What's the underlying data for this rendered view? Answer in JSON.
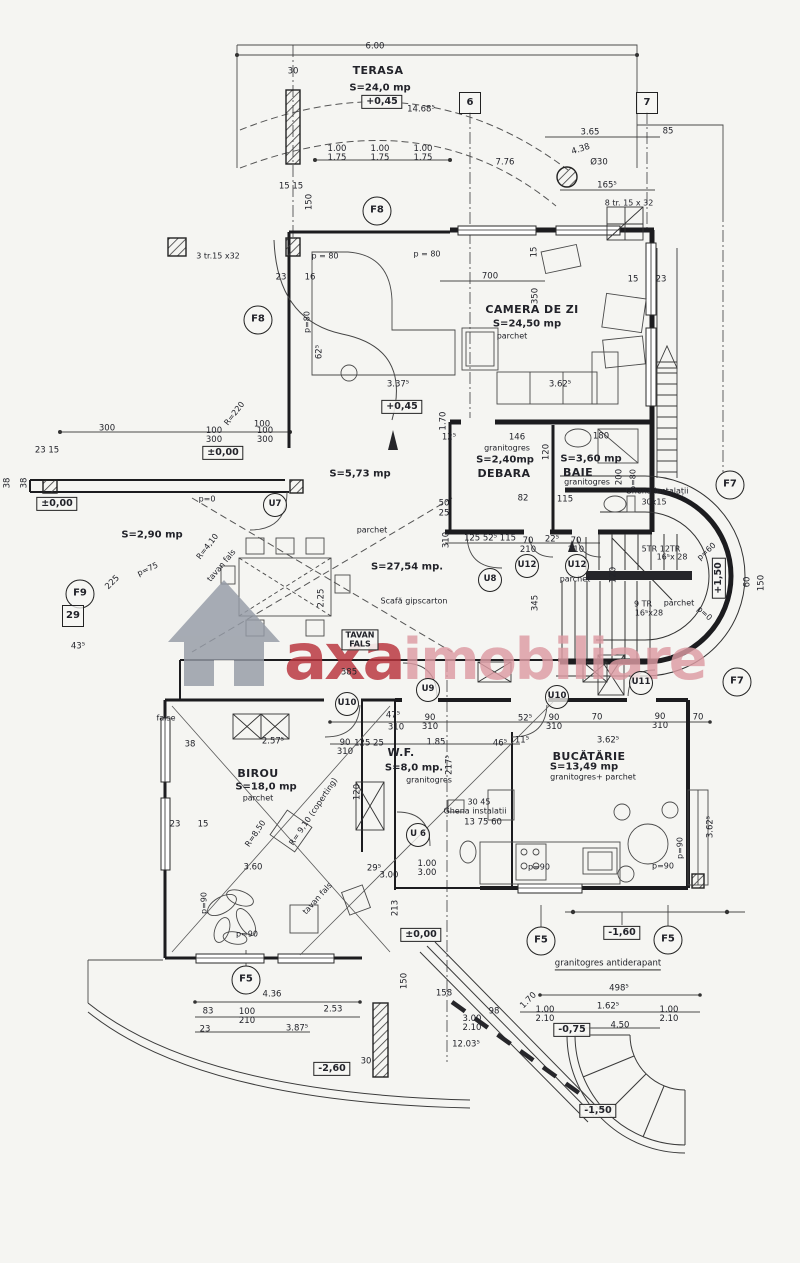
{
  "watermark": {
    "brand": {
      "primary": "axa",
      "secondary": "imobiliare"
    },
    "colors": {
      "primary": "#b9323c",
      "secondary": "#dd9ba3",
      "house": "#959ba6"
    }
  },
  "plan": {
    "labels": [
      {
        "t": "TERASA",
        "x": 378,
        "y": 71,
        "k": "rname"
      },
      {
        "t": "CAMERA DE ZI",
        "x": 532,
        "y": 310,
        "k": "rname"
      },
      {
        "t": "DEBARA",
        "x": 504,
        "y": 474,
        "k": "rname"
      },
      {
        "t": "BAIE",
        "x": 578,
        "y": 473,
        "k": "rname"
      },
      {
        "t": "BIROU",
        "x": 258,
        "y": 774,
        "k": "rname"
      },
      {
        "t": "W.F.",
        "x": 401,
        "y": 753,
        "k": "rname"
      },
      {
        "t": "BUCĂTĂRIE",
        "x": 589,
        "y": 757,
        "k": "rname"
      },
      {
        "t": "S=24,0 mp",
        "x": 380,
        "y": 89,
        "k": "rarea"
      },
      {
        "t": "S=24,50 mp",
        "x": 527,
        "y": 325,
        "k": "rarea"
      },
      {
        "t": "S=2,40mp",
        "x": 505,
        "y": 461,
        "k": "rarea"
      },
      {
        "t": "S=3,60 mp",
        "x": 591,
        "y": 460,
        "k": "rarea"
      },
      {
        "t": "S=5,73 mp",
        "x": 360,
        "y": 475,
        "k": "rarea"
      },
      {
        "t": "S=2,90 mp",
        "x": 152,
        "y": 536,
        "k": "rarea"
      },
      {
        "t": "S=27,54 mp.",
        "x": 407,
        "y": 568,
        "k": "rarea"
      },
      {
        "t": "S=18,0 mp",
        "x": 266,
        "y": 788,
        "k": "rarea"
      },
      {
        "t": "S=8,0 mp.",
        "x": 414,
        "y": 769,
        "k": "rarea"
      },
      {
        "t": "S=13,49 mp",
        "x": 584,
        "y": 768,
        "k": "rarea"
      },
      {
        "t": "parchet",
        "x": 512,
        "y": 337,
        "k": "fin"
      },
      {
        "t": "granitogres",
        "x": 507,
        "y": 449,
        "k": "fin"
      },
      {
        "t": "granitogres",
        "x": 587,
        "y": 483,
        "k": "fin"
      },
      {
        "t": "parchet",
        "x": 372,
        "y": 531,
        "k": "fin"
      },
      {
        "t": "parchet",
        "x": 575,
        "y": 580,
        "k": "fin"
      },
      {
        "t": "parchet",
        "x": 679,
        "y": 604,
        "k": "fin"
      },
      {
        "t": "granitogres",
        "x": 429,
        "y": 781,
        "k": "fin"
      },
      {
        "t": "granitogres+ parchet",
        "x": 593,
        "y": 778,
        "k": "fin"
      },
      {
        "t": "parchet",
        "x": 258,
        "y": 799,
        "k": "fin"
      },
      {
        "t": "Scafă gipscarton",
        "x": 414,
        "y": 602,
        "k": "note"
      },
      {
        "t": "Ghenă instalații",
        "x": 657,
        "y": 492,
        "k": "note"
      },
      {
        "t": "30x15",
        "x": 654,
        "y": 503,
        "k": "note"
      },
      {
        "t": "Ghena instalatii",
        "x": 475,
        "y": 812,
        "k": "note"
      },
      {
        "t": "30 45",
        "x": 479,
        "y": 803,
        "k": "note"
      },
      {
        "t": "false",
        "x": 166,
        "y": 719,
        "k": "note"
      },
      {
        "t": "3 tr.15 x32",
        "x": 218,
        "y": 257,
        "k": "note"
      },
      {
        "t": "8 tr. 15 x 32",
        "x": 629,
        "y": 204,
        "k": "note"
      },
      {
        "t": "5TR  12TR",
        "x": 661,
        "y": 550,
        "k": "note"
      },
      {
        "t": "16⁵x 28",
        "x": 672,
        "y": 558,
        "k": "note"
      },
      {
        "t": "9 TR",
        "x": 643,
        "y": 605,
        "k": "note"
      },
      {
        "t": "16⁵x28",
        "x": 649,
        "y": 614,
        "k": "note"
      },
      {
        "t": "granitogres antiderapant",
        "x": 608,
        "y": 965,
        "k": "noteul"
      },
      {
        "t": "tavan fals",
        "x": 222,
        "y": 566,
        "k": "note",
        "r": -50
      },
      {
        "t": "tavan fals",
        "x": 318,
        "y": 899,
        "k": "note",
        "r": -48
      },
      {
        "t": "p = 80",
        "x": 325,
        "y": 257,
        "k": "slope"
      },
      {
        "t": "p = 80",
        "x": 427,
        "y": 255,
        "k": "slope"
      },
      {
        "t": "p=80",
        "x": 308,
        "y": 322,
        "k": "slope",
        "r": -90
      },
      {
        "t": "p=80",
        "x": 634,
        "y": 480,
        "k": "slope",
        "r": -90
      },
      {
        "t": "p=0",
        "x": 207,
        "y": 500,
        "k": "slope"
      },
      {
        "t": "p=75",
        "x": 148,
        "y": 570,
        "k": "slope",
        "r": -25
      },
      {
        "t": "p=60",
        "x": 707,
        "y": 552,
        "k": "slope",
        "r": -42
      },
      {
        "t": "p=0",
        "x": 704,
        "y": 614,
        "k": "slope",
        "r": 42
      },
      {
        "t": "p=90",
        "x": 247,
        "y": 935,
        "k": "slope"
      },
      {
        "t": "p=90",
        "x": 205,
        "y": 903,
        "k": "slope",
        "r": -90
      },
      {
        "t": "p=90",
        "x": 539,
        "y": 868,
        "k": "slope"
      },
      {
        "t": "p=90",
        "x": 663,
        "y": 867,
        "k": "slope"
      },
      {
        "t": "p=90",
        "x": 681,
        "y": 848,
        "k": "slope",
        "r": -90
      },
      {
        "t": "R=220",
        "x": 235,
        "y": 414,
        "k": "radius",
        "r": -52
      },
      {
        "t": "R=4,10",
        "x": 208,
        "y": 547,
        "k": "radius",
        "r": -52
      },
      {
        "t": "R=8,50",
        "x": 256,
        "y": 834,
        "k": "radius",
        "r": -56
      },
      {
        "t": "R= 9,10 (coperting)",
        "x": 314,
        "y": 812,
        "k": "radius",
        "r": -56
      },
      {
        "t": "+0,45",
        "x": 382,
        "y": 102,
        "k": "level"
      },
      {
        "t": "+0,45",
        "x": 402,
        "y": 407,
        "k": "level"
      },
      {
        "t": "±0,00",
        "x": 223,
        "y": 453,
        "k": "level"
      },
      {
        "t": "±0,00",
        "x": 57,
        "y": 504,
        "k": "level"
      },
      {
        "t": "±0,00",
        "x": 421,
        "y": 935,
        "k": "level"
      },
      {
        "t": "-1,60",
        "x": 622,
        "y": 933,
        "k": "level"
      },
      {
        "t": "-2,60",
        "x": 332,
        "y": 1069,
        "k": "level"
      },
      {
        "t": "-0,75",
        "x": 572,
        "y": 1030,
        "k": "level"
      },
      {
        "t": "-1,50",
        "x": 598,
        "y": 1111,
        "k": "level"
      },
      {
        "t": "+1,50",
        "x": 719,
        "y": 578,
        "k": "level",
        "r": -90
      },
      {
        "t": "TAVAN\nFALS",
        "x": 360,
        "y": 640,
        "k": "box2"
      },
      {
        "t": "F8",
        "x": 377,
        "y": 211,
        "k": "axisF"
      },
      {
        "t": "F8",
        "x": 258,
        "y": 320,
        "k": "axisF"
      },
      {
        "t": "F9",
        "x": 80,
        "y": 594,
        "k": "axisF"
      },
      {
        "t": "F7",
        "x": 730,
        "y": 485,
        "k": "axisF"
      },
      {
        "t": "F7",
        "x": 737,
        "y": 682,
        "k": "axisF"
      },
      {
        "t": "F5",
        "x": 246,
        "y": 980,
        "k": "axisF"
      },
      {
        "t": "F5",
        "x": 541,
        "y": 941,
        "k": "axisF"
      },
      {
        "t": "F5",
        "x": 668,
        "y": 940,
        "k": "axisF"
      },
      {
        "t": "U7",
        "x": 275,
        "y": 505,
        "k": "axisU"
      },
      {
        "t": "U8",
        "x": 490,
        "y": 580,
        "k": "axisU"
      },
      {
        "t": "U9",
        "x": 428,
        "y": 690,
        "k": "axisU"
      },
      {
        "t": "U10",
        "x": 347,
        "y": 704,
        "k": "axisU"
      },
      {
        "t": "U10",
        "x": 557,
        "y": 697,
        "k": "axisU"
      },
      {
        "t": "U11",
        "x": 641,
        "y": 683,
        "k": "axisU"
      },
      {
        "t": "U12",
        "x": 527,
        "y": 566,
        "k": "axisU"
      },
      {
        "t": "U12",
        "x": 577,
        "y": 566,
        "k": "axisU"
      },
      {
        "t": "U 6",
        "x": 418,
        "y": 835,
        "k": "axisU"
      },
      {
        "t": "6",
        "x": 470,
        "y": 103,
        "k": "grid"
      },
      {
        "t": "7",
        "x": 647,
        "y": 103,
        "k": "grid"
      },
      {
        "t": "29",
        "x": 73,
        "y": 616,
        "k": "grid"
      },
      {
        "t": "6.00",
        "x": 375,
        "y": 47,
        "k": "dim"
      },
      {
        "t": "30",
        "x": 293,
        "y": 72,
        "k": "dim"
      },
      {
        "t": "14.68⁵",
        "x": 421,
        "y": 110,
        "k": "dim"
      },
      {
        "t": "3.65",
        "x": 590,
        "y": 133,
        "k": "dim"
      },
      {
        "t": "85",
        "x": 668,
        "y": 132,
        "k": "dim"
      },
      {
        "t": "1.00\n1.75",
        "x": 337,
        "y": 154,
        "k": "dim2"
      },
      {
        "t": "1.00\n1.75",
        "x": 380,
        "y": 154,
        "k": "dim2"
      },
      {
        "t": "1.00\n1.75",
        "x": 423,
        "y": 154,
        "k": "dim2"
      },
      {
        "t": "7.76",
        "x": 505,
        "y": 163,
        "k": "dim"
      },
      {
        "t": "4.38",
        "x": 581,
        "y": 150,
        "k": "dim",
        "r": -18
      },
      {
        "t": "Ø30",
        "x": 599,
        "y": 163,
        "k": "dim"
      },
      {
        "t": "165⁵",
        "x": 607,
        "y": 186,
        "k": "dim"
      },
      {
        "t": "15 15",
        "x": 291,
        "y": 187,
        "k": "dim"
      },
      {
        "t": "150",
        "x": 310,
        "y": 202,
        "k": "dim",
        "r": -90
      },
      {
        "t": "23",
        "x": 281,
        "y": 278,
        "k": "dim"
      },
      {
        "t": "16",
        "x": 310,
        "y": 278,
        "k": "dim"
      },
      {
        "t": "700",
        "x": 490,
        "y": 277,
        "k": "dim"
      },
      {
        "t": "15",
        "x": 535,
        "y": 252,
        "k": "dim",
        "r": -90
      },
      {
        "t": "350",
        "x": 536,
        "y": 296,
        "k": "dim",
        "r": -90
      },
      {
        "t": "15",
        "x": 633,
        "y": 280,
        "k": "dim"
      },
      {
        "t": "23",
        "x": 661,
        "y": 280,
        "k": "dim"
      },
      {
        "t": "62⁵",
        "x": 320,
        "y": 352,
        "k": "dim",
        "r": -90
      },
      {
        "t": "3.37⁵",
        "x": 398,
        "y": 385,
        "k": "dim"
      },
      {
        "t": "3.62⁵",
        "x": 560,
        "y": 385,
        "k": "dim"
      },
      {
        "t": "100",
        "x": 262,
        "y": 425,
        "k": "dim"
      },
      {
        "t": "300",
        "x": 107,
        "y": 429,
        "k": "dim"
      },
      {
        "t": "100\n300",
        "x": 214,
        "y": 436,
        "k": "dim2"
      },
      {
        "t": "100\n300",
        "x": 265,
        "y": 436,
        "k": "dim2"
      },
      {
        "t": "23 15",
        "x": 47,
        "y": 451,
        "k": "dim"
      },
      {
        "t": "38",
        "x": 8,
        "y": 483,
        "k": "dim",
        "r": -90
      },
      {
        "t": "38",
        "x": 25,
        "y": 483,
        "k": "dim",
        "r": -90
      },
      {
        "t": "1.70",
        "x": 444,
        "y": 421,
        "k": "dim",
        "r": -90
      },
      {
        "t": "12⁵",
        "x": 449,
        "y": 438,
        "k": "dim"
      },
      {
        "t": "146",
        "x": 517,
        "y": 438,
        "k": "dim"
      },
      {
        "t": "120",
        "x": 547,
        "y": 452,
        "k": "dim",
        "r": -90
      },
      {
        "t": "180",
        "x": 601,
        "y": 437,
        "k": "dim"
      },
      {
        "t": "200",
        "x": 620,
        "y": 477,
        "k": "dim",
        "r": -90
      },
      {
        "t": "82",
        "x": 523,
        "y": 499,
        "k": "dim"
      },
      {
        "t": "115",
        "x": 565,
        "y": 500,
        "k": "dim"
      },
      {
        "t": "50",
        "x": 444,
        "y": 504,
        "k": "dim"
      },
      {
        "t": "25",
        "x": 444,
        "y": 514,
        "k": "dim"
      },
      {
        "t": "310",
        "x": 447,
        "y": 540,
        "k": "dim",
        "r": -90
      },
      {
        "t": "125 52⁵ 115",
        "x": 490,
        "y": 539,
        "k": "dim"
      },
      {
        "t": "70\n210",
        "x": 528,
        "y": 546,
        "k": "dim2"
      },
      {
        "t": "22⁵",
        "x": 552,
        "y": 540,
        "k": "dim"
      },
      {
        "t": "70\n210",
        "x": 576,
        "y": 546,
        "k": "dim2"
      },
      {
        "t": "345",
        "x": 536,
        "y": 603,
        "k": "dim",
        "r": -90
      },
      {
        "t": "225",
        "x": 113,
        "y": 583,
        "k": "dim",
        "r": -45
      },
      {
        "t": "2.25",
        "x": 322,
        "y": 598,
        "k": "dim",
        "r": -90
      },
      {
        "t": "43⁵",
        "x": 78,
        "y": 647,
        "k": "dim"
      },
      {
        "t": "385",
        "x": 349,
        "y": 673,
        "k": "dim"
      },
      {
        "t": "120",
        "x": 614,
        "y": 575,
        "k": "dim",
        "r": -90
      },
      {
        "t": "60",
        "x": 748,
        "y": 582,
        "k": "dim",
        "r": -90
      },
      {
        "t": "150",
        "x": 762,
        "y": 583,
        "k": "dim",
        "r": -90
      },
      {
        "t": "38",
        "x": 190,
        "y": 745,
        "k": "dim"
      },
      {
        "t": "2.57⁵",
        "x": 273,
        "y": 742,
        "k": "dim"
      },
      {
        "t": "90\n310",
        "x": 345,
        "y": 748,
        "k": "dim2"
      },
      {
        "t": "125 25",
        "x": 369,
        "y": 744,
        "k": "dim"
      },
      {
        "t": "47⁵",
        "x": 393,
        "y": 716,
        "k": "dim"
      },
      {
        "t": "310",
        "x": 396,
        "y": 728,
        "k": "dim"
      },
      {
        "t": "90\n310",
        "x": 430,
        "y": 723,
        "k": "dim2"
      },
      {
        "t": "1.85",
        "x": 436,
        "y": 743,
        "k": "dim"
      },
      {
        "t": "52⁵",
        "x": 525,
        "y": 719,
        "k": "dim"
      },
      {
        "t": "90\n310",
        "x": 554,
        "y": 723,
        "k": "dim2"
      },
      {
        "t": "70",
        "x": 597,
        "y": 718,
        "k": "dim"
      },
      {
        "t": "90\n310",
        "x": 660,
        "y": 722,
        "k": "dim2"
      },
      {
        "t": "70",
        "x": 698,
        "y": 718,
        "k": "dim"
      },
      {
        "t": "3.62⁵",
        "x": 608,
        "y": 741,
        "k": "dim"
      },
      {
        "t": "11⁵",
        "x": 522,
        "y": 741,
        "k": "dim"
      },
      {
        "t": "46⁵",
        "x": 500,
        "y": 744,
        "k": "dim"
      },
      {
        "t": "217⁵",
        "x": 450,
        "y": 765,
        "k": "dim",
        "r": -90
      },
      {
        "t": "13 75 60",
        "x": 483,
        "y": 823,
        "k": "dim"
      },
      {
        "t": "120",
        "x": 358,
        "y": 792,
        "k": "dim",
        "r": -90
      },
      {
        "t": "23",
        "x": 175,
        "y": 825,
        "k": "dim"
      },
      {
        "t": "15",
        "x": 203,
        "y": 825,
        "k": "dim"
      },
      {
        "t": "3.60",
        "x": 253,
        "y": 868,
        "k": "dim"
      },
      {
        "t": "1.00\n3.00",
        "x": 427,
        "y": 869,
        "k": "dim2"
      },
      {
        "t": "213",
        "x": 396,
        "y": 908,
        "k": "dim",
        "r": -90
      },
      {
        "t": "3.00",
        "x": 389,
        "y": 876,
        "k": "dim"
      },
      {
        "t": "29⁵",
        "x": 374,
        "y": 869,
        "k": "dim"
      },
      {
        "t": "3.62⁵",
        "x": 711,
        "y": 827,
        "k": "dim",
        "r": -90
      },
      {
        "t": "4.36",
        "x": 272,
        "y": 995,
        "k": "dim"
      },
      {
        "t": "83",
        "x": 208,
        "y": 1012,
        "k": "dim"
      },
      {
        "t": "100\n210",
        "x": 247,
        "y": 1017,
        "k": "dim2"
      },
      {
        "t": "2.53",
        "x": 333,
        "y": 1010,
        "k": "dim"
      },
      {
        "t": "23",
        "x": 205,
        "y": 1030,
        "k": "dim"
      },
      {
        "t": "3.87⁵",
        "x": 297,
        "y": 1029,
        "k": "dim"
      },
      {
        "t": "30",
        "x": 366,
        "y": 1062,
        "k": "dim"
      },
      {
        "t": "150",
        "x": 405,
        "y": 981,
        "k": "dim",
        "r": -90
      },
      {
        "t": "158",
        "x": 444,
        "y": 994,
        "k": "dim"
      },
      {
        "t": "3.00\n2.10",
        "x": 472,
        "y": 1024,
        "k": "dim2"
      },
      {
        "t": "12.03⁵",
        "x": 466,
        "y": 1045,
        "k": "dim"
      },
      {
        "t": "98",
        "x": 494,
        "y": 1012,
        "k": "dim"
      },
      {
        "t": "1.70",
        "x": 529,
        "y": 1001,
        "k": "dim",
        "r": -45
      },
      {
        "t": "498⁵",
        "x": 619,
        "y": 989,
        "k": "dim"
      },
      {
        "t": "1.00\n2.10",
        "x": 545,
        "y": 1015,
        "k": "dim2"
      },
      {
        "t": "1.62⁵",
        "x": 608,
        "y": 1007,
        "k": "dim"
      },
      {
        "t": "1.00\n2.10",
        "x": 669,
        "y": 1015,
        "k": "dim2"
      },
      {
        "t": "4.50",
        "x": 620,
        "y": 1026,
        "k": "dim"
      }
    ]
  }
}
